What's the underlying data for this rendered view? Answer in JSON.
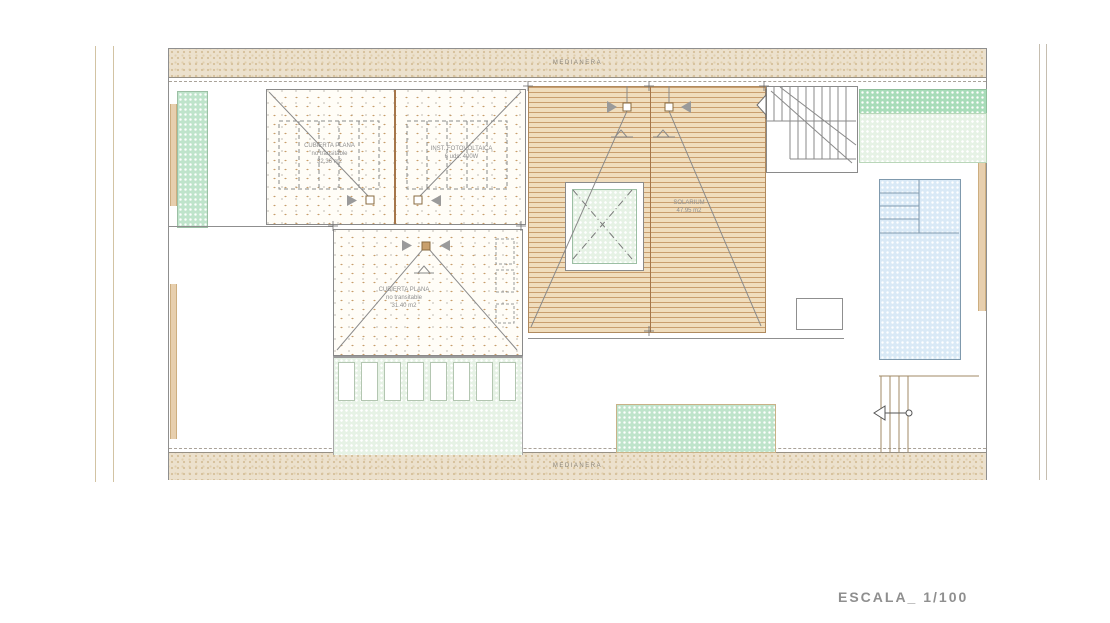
{
  "meta": {
    "scale_label": "ESCALA_ 1/100"
  },
  "boundaries": {
    "top_label": "MEDIANERA",
    "bottom_label": "MEDIANERA"
  },
  "rooms": {
    "roof_left": {
      "line1": "CUBIERTA PLANA",
      "line2": "no transitable",
      "line3": "32.36 m2"
    },
    "roof_pv": {
      "line1": "INST. FOTOVOLTAICA",
      "line2": "6 uds. 400W"
    },
    "roof_mid": {
      "line1": "CUBIERTA PLANA",
      "line2": "no transitable",
      "line3": "31.40 m2"
    },
    "solarium": {
      "line1": "SOLARIUM",
      "line2": "47.95 m2"
    }
  },
  "colors": {
    "boundary_sand": "#ece1cd",
    "deck_board": "#f0ddbd",
    "deck_line": "#c99e6e",
    "vegetation_green": "#bfe4cb",
    "vegetation_pale": "#e6f2e5",
    "pool_blue": "#d9e9f6",
    "wall_tan": "#e7cfae",
    "linework_gray": "#8a8a8a",
    "text_gray": "#8f8f8f"
  }
}
